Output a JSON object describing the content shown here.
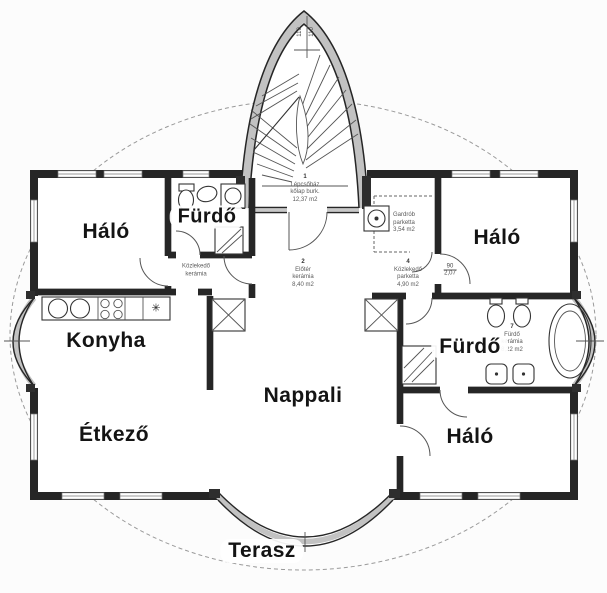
{
  "colors": {
    "wall_edge": "#262626",
    "wall_fill": "#c2c2c2",
    "annotation": "#5a5a5a",
    "label": "#141414",
    "site_dash": "#9a9a9a"
  },
  "rooms": {
    "halo_tl": "Háló",
    "furdo_tl": "Fürdő",
    "halo_tr": "Háló",
    "konyha": "Konyha",
    "furdo_r": "Fürdő",
    "nappali": "Nappali",
    "etkezo": "Étkező",
    "halo_br": "Háló",
    "terasz": "Terasz"
  },
  "annotations": {
    "stair": {
      "num": "1",
      "name": "Lépcsőház",
      "floor": "kőlap burk.",
      "area": "12,37 m2"
    },
    "eloter": {
      "num": "2",
      "name": "Előtér",
      "floor": "kerámia",
      "area": "8,40 m2"
    },
    "kozlekedo_left": {
      "name": "Közlekedő",
      "floor": "kerámia"
    },
    "gardrob": {
      "name": "Gardrób",
      "floor": "parketta",
      "area": "3,54 m2"
    },
    "kozlekedo_right": {
      "num": "4",
      "name": "Közlekedő",
      "floor": "parketta",
      "area": "4,90 m2"
    },
    "furdo_right": {
      "num": "7",
      "name": "Fürdő",
      "floor": "kerámia",
      "area": "8,22 m2"
    },
    "door_dim": {
      "width": "90",
      "height": "2,07"
    },
    "arch_dim_left": "110",
    "arch_dim_right": "110"
  },
  "symbols": {
    "kitchen_star": "✳"
  }
}
